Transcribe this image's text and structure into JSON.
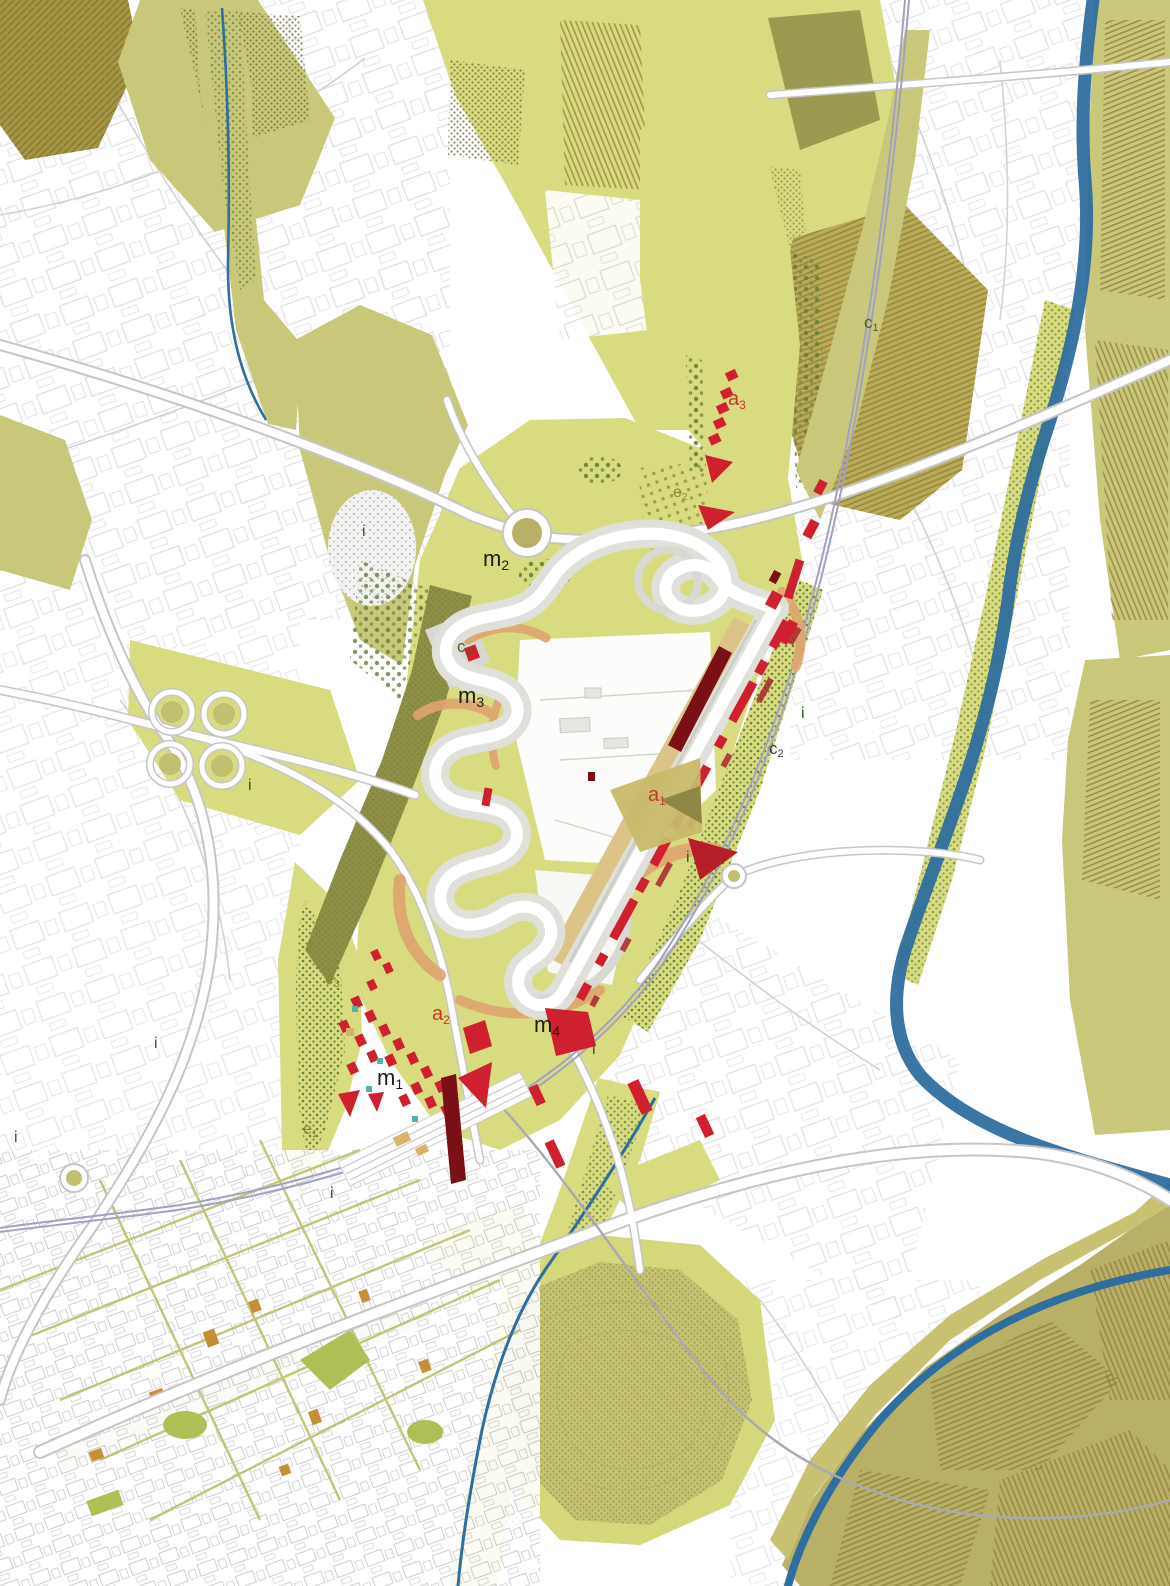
{
  "map": {
    "description": "Masterplan map of a motor racing circuit valley with surrounding town, agricultural fields, motorways, railway and river",
    "palette": {
      "field_bright": "#d8db7f",
      "field_mid": "#c9c77a",
      "field_khaki": "#b9b068",
      "field_ochre": "#a59441",
      "field_darkband": "#8f9048",
      "field_pale": "#cdd0a0",
      "forest_dot": "#5a7a33",
      "river_blue": "#2f6e9e",
      "road_white": "#ffffff",
      "road_casing": "#c6c6c6",
      "railway": "#a2a2c0",
      "runoff_gray": "#e0e0da",
      "track_white": "#ffffff",
      "building_red": "#cf2030",
      "building_maroon": "#7a1016",
      "building_ochre": "#c08a2e",
      "building_teal": "#56b1a6",
      "embankment_orange": "#dfa470",
      "grandstand_tan": "#dcc388",
      "urban_line": "#d6d6da",
      "town_line": "#c2c2c6",
      "label_black": "#1c1c1c",
      "label_red": "#c5392b",
      "label_olive": "#8a8a2f",
      "label_olive_dark": "#5a5a20",
      "label_green": "#2e5b1e",
      "label_darkgray": "#3c3c3c"
    },
    "labels": [
      {
        "id": "m2",
        "text": "m",
        "sub": "2",
        "x": 483,
        "y": 566,
        "color": "label_black",
        "size": 22
      },
      {
        "id": "m3",
        "text": "m",
        "sub": "3",
        "x": 458,
        "y": 703,
        "color": "label_black",
        "size": 22
      },
      {
        "id": "m1",
        "text": "m",
        "sub": "1",
        "x": 377,
        "y": 1085,
        "color": "label_black",
        "size": 22
      },
      {
        "id": "m4",
        "text": "m",
        "sub": "4",
        "x": 534,
        "y": 1032,
        "color": "label_black",
        "size": 22
      },
      {
        "id": "a1",
        "text": "a",
        "sub": "1",
        "x": 648,
        "y": 801,
        "color": "label_red",
        "size": 20
      },
      {
        "id": "a2",
        "text": "a",
        "sub": "2",
        "x": 432,
        "y": 1020,
        "color": "label_red",
        "size": 20
      },
      {
        "id": "a3",
        "text": "a",
        "sub": "3",
        "x": 728,
        "y": 405,
        "color": "label_red",
        "size": 20
      },
      {
        "id": "c1",
        "text": "c",
        "sub": "1",
        "x": 864,
        "y": 328,
        "color": "label_olive_dark",
        "size": 17
      },
      {
        "id": "c2",
        "text": "c",
        "sub": "2",
        "x": 769,
        "y": 754,
        "color": "label_darkgray",
        "size": 17
      },
      {
        "id": "c3",
        "text": "c",
        "sub": "3",
        "x": 457,
        "y": 652,
        "color": "label_olive_dark",
        "size": 17
      },
      {
        "id": "e1",
        "text": "e",
        "sub": "1",
        "x": 303,
        "y": 1134,
        "color": "label_olive",
        "size": 16
      },
      {
        "id": "e2",
        "text": "e",
        "sub": "2",
        "x": 673,
        "y": 497,
        "color": "label_olive",
        "size": 16
      },
      {
        "id": "e3",
        "text": "e",
        "sub": "3",
        "x": 325,
        "y": 984,
        "color": "label_olive",
        "size": 16
      },
      {
        "id": "i1",
        "text": "i",
        "sub": "",
        "x": 362,
        "y": 536,
        "color": "label_green",
        "size": 16
      },
      {
        "id": "i2",
        "text": "i",
        "sub": "",
        "x": 248,
        "y": 790,
        "color": "label_green",
        "size": 16
      },
      {
        "id": "i3",
        "text": "i",
        "sub": "",
        "x": 154,
        "y": 1048,
        "color": "label_green",
        "size": 16
      },
      {
        "id": "i4",
        "text": "i",
        "sub": "",
        "x": 14,
        "y": 1142,
        "color": "label_green",
        "size": 16
      },
      {
        "id": "i5",
        "text": "i",
        "sub": "",
        "x": 330,
        "y": 1198,
        "color": "label_green",
        "size": 16
      },
      {
        "id": "i6",
        "text": "i",
        "sub": "",
        "x": 592,
        "y": 1054,
        "color": "label_green",
        "size": 16
      },
      {
        "id": "i7",
        "text": "i",
        "sub": "",
        "x": 801,
        "y": 718,
        "color": "label_green",
        "size": 16
      },
      {
        "id": "i8",
        "text": "i",
        "sub": "",
        "x": 686,
        "y": 862,
        "color": "label_green",
        "size": 16
      }
    ]
  }
}
